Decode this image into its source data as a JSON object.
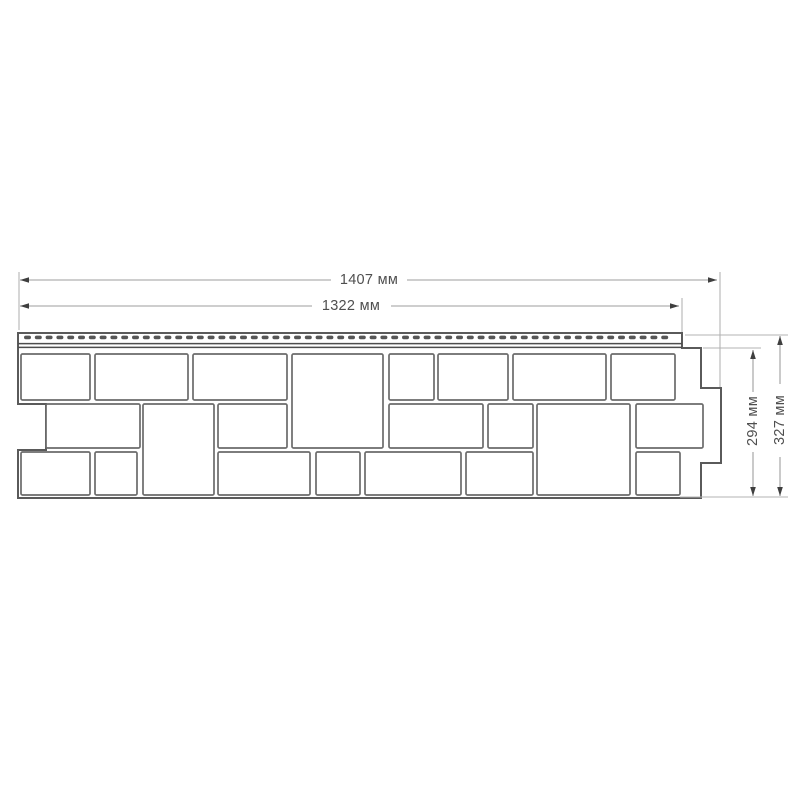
{
  "page": {
    "background": "#ffffff"
  },
  "drawing": {
    "title": "facade-panel-dimension-drawing",
    "colors": {
      "panel_outline": "#5a5a5a",
      "block_outline": "#6b6b6b",
      "strip_detail": "#4d4d4d",
      "slot_fill": "#565656",
      "dim_line": "#9e9e9e",
      "ext_line": "#b3b3b3",
      "arrow": "#3f3f3f",
      "label_text": "#4f4f4f",
      "fill": "#ffffff"
    },
    "panel": {
      "outline_points": "18,333 682,333 682,348 701,348 701,388 721,388 721,463 701,463 701,498 18,498 18,450 46,450 46,404 18,404",
      "nail_strip": {
        "slot_x1": 24,
        "slot_x2": 676,
        "slot_period": 10.8,
        "slot_w": 7,
        "slot_h": 3.6,
        "slot_y": 335.6,
        "lines": [
          {
            "y": 343.6,
            "x1": 18,
            "x2": 682
          },
          {
            "y": 347.4,
            "x1": 18,
            "x2": 682
          }
        ]
      },
      "blocks": [
        {
          "x": 21,
          "y": 354,
          "w": 69,
          "h": 46
        },
        {
          "x": 95,
          "y": 354,
          "w": 93,
          "h": 46
        },
        {
          "x": 193,
          "y": 354,
          "w": 94,
          "h": 46
        },
        {
          "x": 292,
          "y": 354,
          "w": 91,
          "h": 94
        },
        {
          "x": 389,
          "y": 354,
          "w": 45,
          "h": 46
        },
        {
          "x": 438,
          "y": 354,
          "w": 70,
          "h": 46
        },
        {
          "x": 513,
          "y": 354,
          "w": 93,
          "h": 46
        },
        {
          "x": 611,
          "y": 354,
          "w": 64,
          "h": 46
        },
        {
          "x": 46,
          "y": 404,
          "w": 94,
          "h": 44
        },
        {
          "x": 143,
          "y": 404,
          "w": 71,
          "h": 91
        },
        {
          "x": 218,
          "y": 404,
          "w": 69,
          "h": 44
        },
        {
          "x": 389,
          "y": 404,
          "w": 94,
          "h": 44
        },
        {
          "x": 488,
          "y": 404,
          "w": 45,
          "h": 44
        },
        {
          "x": 537,
          "y": 404,
          "w": 93,
          "h": 91
        },
        {
          "x": 636,
          "y": 404,
          "w": 67,
          "h": 44
        },
        {
          "x": 21,
          "y": 452,
          "w": 69,
          "h": 43
        },
        {
          "x": 95,
          "y": 452,
          "w": 42,
          "h": 43
        },
        {
          "x": 218,
          "y": 452,
          "w": 92,
          "h": 43
        },
        {
          "x": 316,
          "y": 452,
          "w": 44,
          "h": 43
        },
        {
          "x": 365,
          "y": 452,
          "w": 96,
          "h": 43
        },
        {
          "x": 466,
          "y": 452,
          "w": 67,
          "h": 43
        },
        {
          "x": 636,
          "y": 452,
          "w": 44,
          "h": 43
        }
      ]
    },
    "dimensions": [
      {
        "id": "width-total",
        "label": "1407 мм",
        "orient": "h",
        "line": 280,
        "from": 20,
        "to": 717,
        "text_center": 369,
        "gap": [
          331,
          407
        ]
      },
      {
        "id": "width-lock",
        "label": "1322 мм",
        "orient": "h",
        "line": 306,
        "from": 20,
        "to": 679,
        "text_center": 351,
        "gap": [
          312,
          391
        ]
      },
      {
        "id": "height-body",
        "label": "294 мм",
        "orient": "v",
        "line": 753,
        "from": 350,
        "to": 496,
        "text_center": 421,
        "gap": [
          392,
          452
        ]
      },
      {
        "id": "height-total",
        "label": "327 мм",
        "orient": "v",
        "line": 780,
        "from": 336,
        "to": 496,
        "text_center": 420,
        "gap": [
          384,
          457
        ]
      }
    ],
    "extension_lines": [
      {
        "x1": 19,
        "y1": 272,
        "x2": 19,
        "y2": 330
      },
      {
        "x1": 720,
        "y1": 272,
        "x2": 720,
        "y2": 387
      },
      {
        "x1": 682,
        "y1": 298,
        "x2": 682,
        "y2": 332
      },
      {
        "x1": 703,
        "y1": 348,
        "x2": 761,
        "y2": 348
      },
      {
        "x1": 685,
        "y1": 335,
        "x2": 788,
        "y2": 335
      },
      {
        "x1": 680,
        "y1": 497,
        "x2": 788,
        "y2": 497
      }
    ]
  }
}
